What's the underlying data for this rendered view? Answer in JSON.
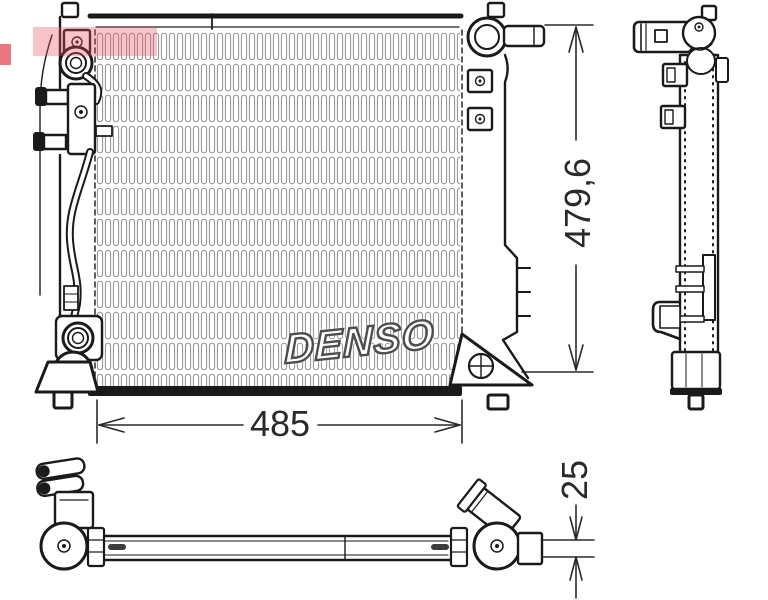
{
  "brand_watermark": {
    "text": "DENSO"
  },
  "core_logo": {
    "text": "DENSO"
  },
  "dimensions": {
    "width": "485",
    "height": "479,6",
    "depth": "25"
  },
  "colors": {
    "line": "#1a1a1a",
    "fin": "#8f8f8f",
    "dim": "#2a2a2a",
    "wm_band": "rgba(232,84,96,0.34)",
    "wm_red": "rgba(226,32,48,0.62)"
  }
}
